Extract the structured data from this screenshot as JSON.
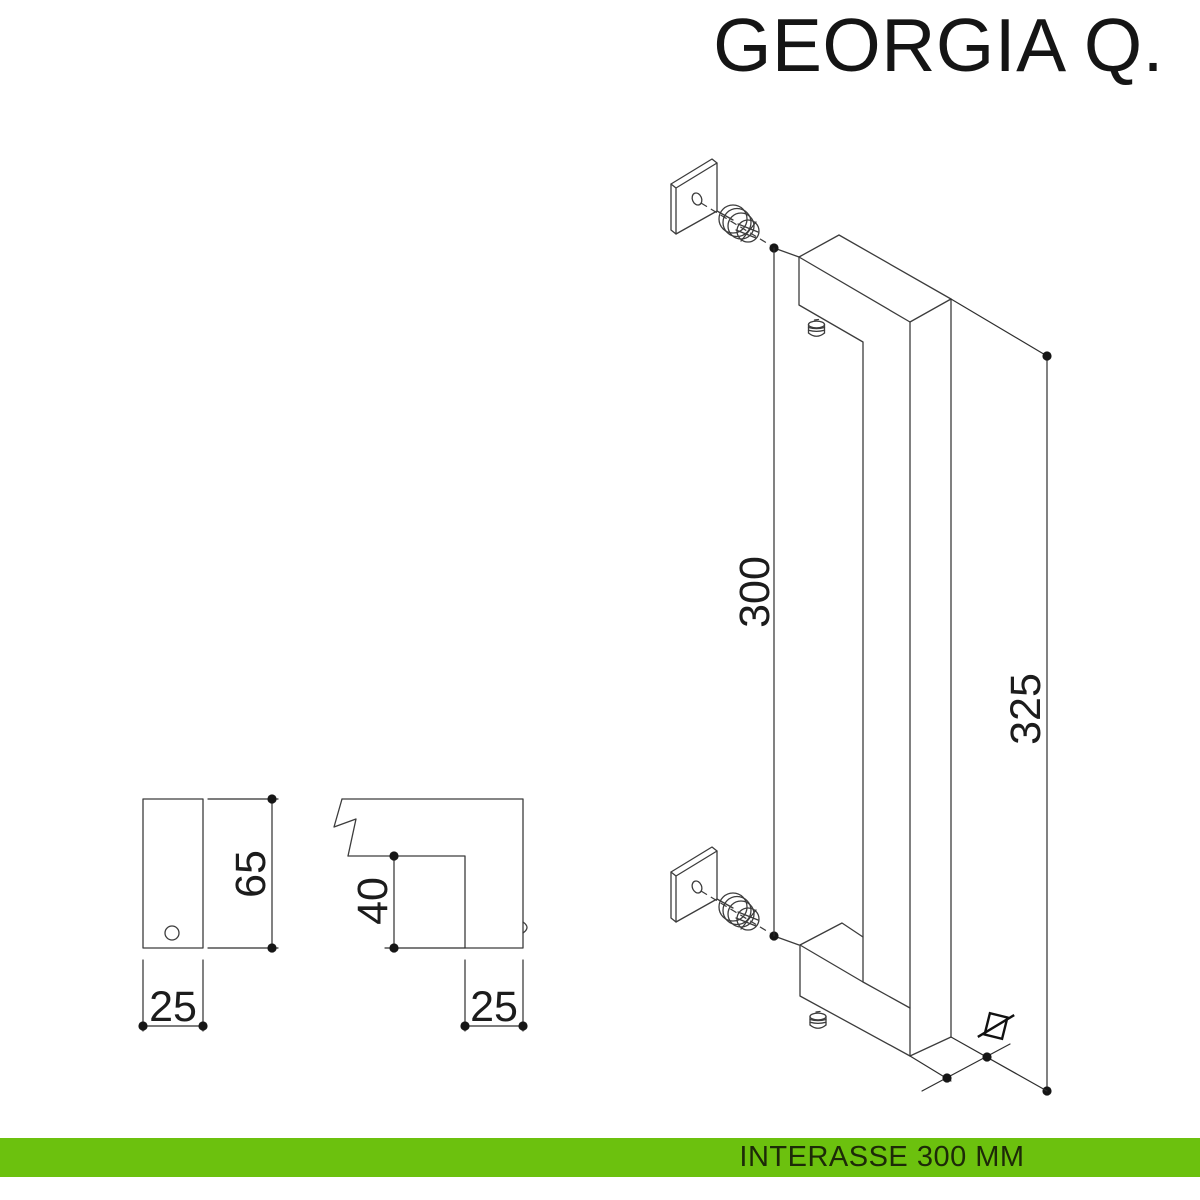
{
  "title": "GEORGIA Q.",
  "footer": {
    "label": "INTERASSE 300 MM"
  },
  "dimensions": {
    "interasse": "300",
    "overall": "325",
    "plate_height": "65",
    "plate_width": "25",
    "section_height": "40",
    "section_width": "25"
  },
  "symbols": {
    "square_section": "crossed-square"
  },
  "colors": {
    "accent_green": "#6cc10e",
    "line": "#3c3c3c",
    "text": "#1c1c1c"
  }
}
